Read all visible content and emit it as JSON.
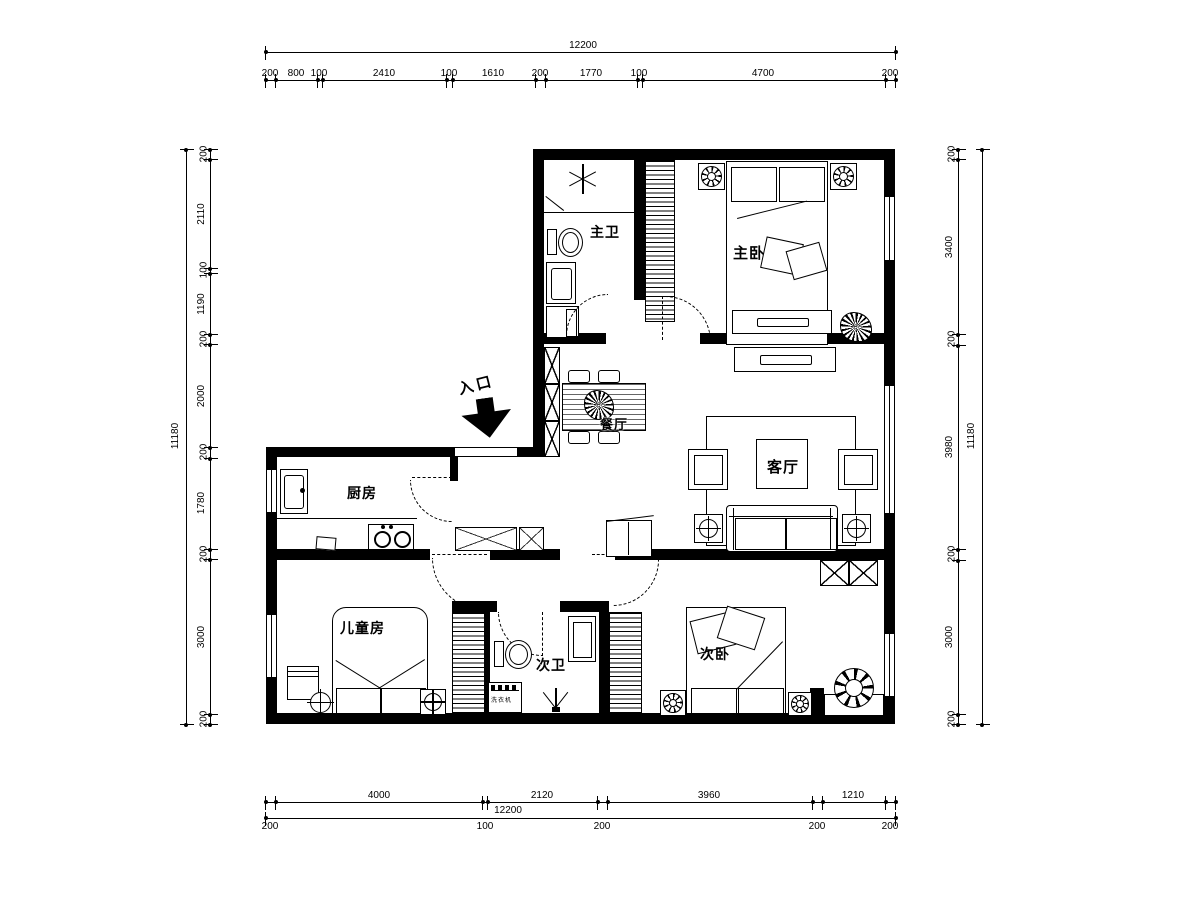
{
  "rooms": {
    "master_bath": "主卫",
    "master_bedroom": "主卧",
    "dining": "餐厅",
    "living": "客厅",
    "kitchen": "厨房",
    "kids_room": "儿童房",
    "second_bath": "次卫",
    "second_bedroom": "次卧",
    "entrance": "入口"
  },
  "appliances": {
    "washer": "洗衣机"
  },
  "dims": {
    "top": {
      "total": "12200",
      "segments": [
        "200",
        "800",
        "100",
        "2410",
        "100",
        "1610",
        "200",
        "1770",
        "100",
        "4700",
        "200"
      ]
    },
    "bottom": {
      "total": "12200",
      "main": [
        "4000",
        "2120",
        "3960",
        "1210"
      ],
      "small": [
        "200",
        "100",
        "200",
        "200",
        "200"
      ]
    },
    "left": {
      "total": "11180",
      "segments": [
        "200",
        "2110",
        "100",
        "1190",
        "200",
        "2000",
        "200",
        "1780",
        "200",
        "3000",
        "200"
      ]
    },
    "right": {
      "total": "11180",
      "segments": [
        "200",
        "3400",
        "200",
        "3980",
        "200",
        "3000",
        "200"
      ]
    }
  }
}
